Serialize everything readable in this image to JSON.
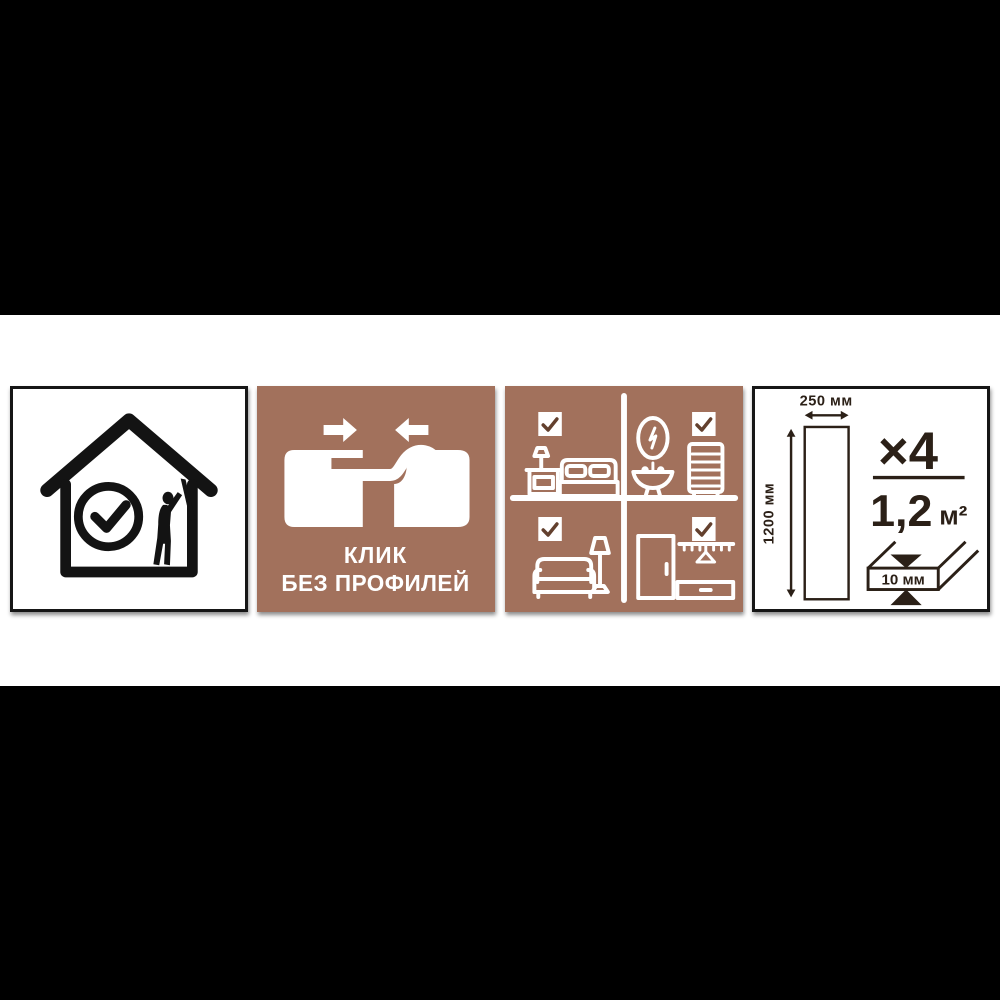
{
  "colors": {
    "page_background": "#000000",
    "band_background": "#ffffff",
    "panel_brown": "#a2715c",
    "panel_border": "#161616",
    "icon_white": "#ffffff",
    "icon_black": "#131313",
    "dark_text": "#2b2017",
    "checkmark_brown": "#63402e"
  },
  "icons": {
    "panel_quality": [
      "house-check-icon",
      "installer-icon"
    ],
    "panel_click": [
      "arrow-right-icon",
      "arrow-left-icon",
      "click-joint-icon"
    ],
    "panel_rooms": [
      "checkbox-checked-icon",
      "bedroom-icon",
      "bathroom-icon",
      "living-room-icon",
      "hallway-icon"
    ],
    "panel_dimensions": [
      "width-arrow",
      "height-arrow",
      "panel-outline",
      "thickness-diagram"
    ]
  },
  "click_panel": {
    "title_line1": "КЛИК",
    "title_line2": "БЕЗ ПРОФИЛЕЙ"
  },
  "dimensions_panel": {
    "width_label": "250 мм",
    "height_label": "1200 мм",
    "quantity_label": "×4",
    "area_value": "1,2",
    "area_unit": "м²",
    "thickness_label": "10 мм"
  }
}
